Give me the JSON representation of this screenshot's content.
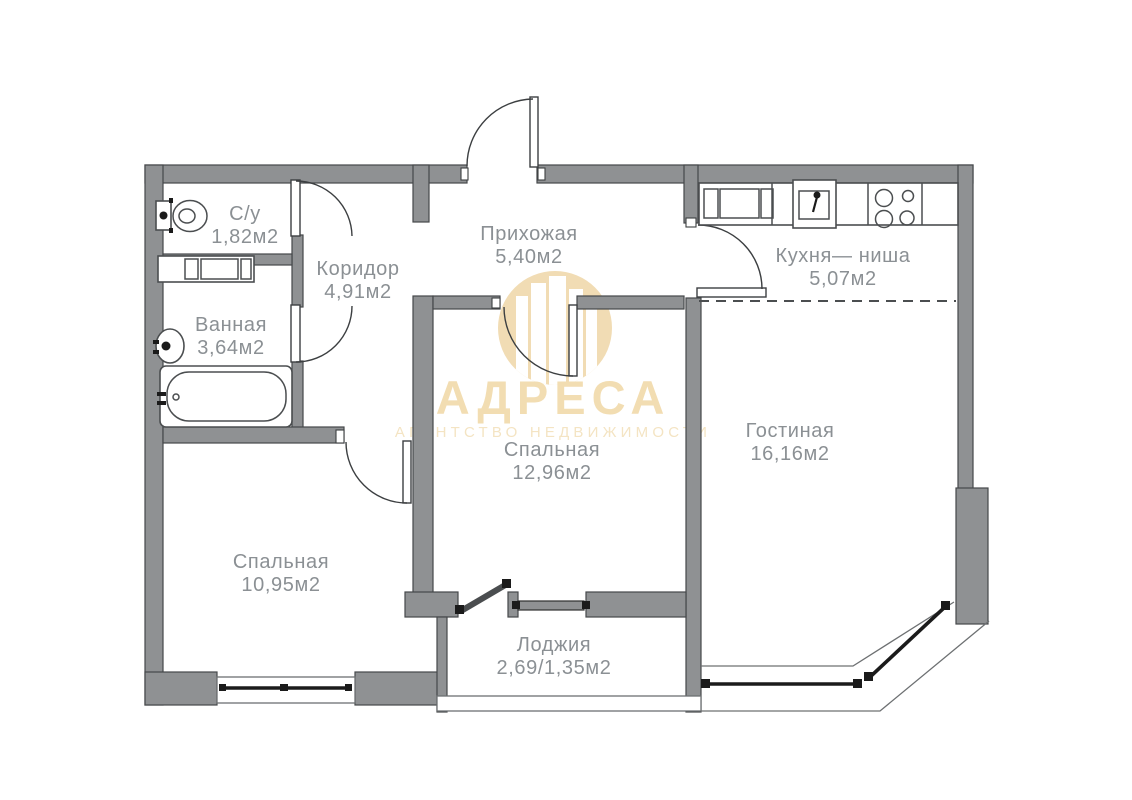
{
  "watermark": {
    "title": "АДРЕСА",
    "subtitle": "АГЕНТСТВО НЕДВИЖИМОСТИ"
  },
  "rooms": [
    {
      "name": "С/у",
      "area": "1,82м2"
    },
    {
      "name": "Коридор",
      "area": "4,91м2"
    },
    {
      "name": "Прихожая",
      "area": "5,40м2"
    },
    {
      "name": "Кухня— ниша",
      "area": "5,07м2"
    },
    {
      "name": "Ванная",
      "area": "3,64м2"
    },
    {
      "name": "Спальная",
      "area": "12,96м2"
    },
    {
      "name": "Гостиная",
      "area": "16,16м2"
    },
    {
      "name": "Спальная",
      "area": "10,95м2"
    },
    {
      "name": "Лоджия",
      "area": "2,69/1,35м2"
    }
  ],
  "colors": {
    "background": "#ffffff",
    "wall_fill": "#8f9193",
    "wall_stroke": "#45484a",
    "line": "#3c3f41",
    "label_text": "#8b9094",
    "watermark_gold": "#f1dcb4",
    "watermark_text": "#f2ddb2",
    "glass": "#1b1b1b"
  }
}
